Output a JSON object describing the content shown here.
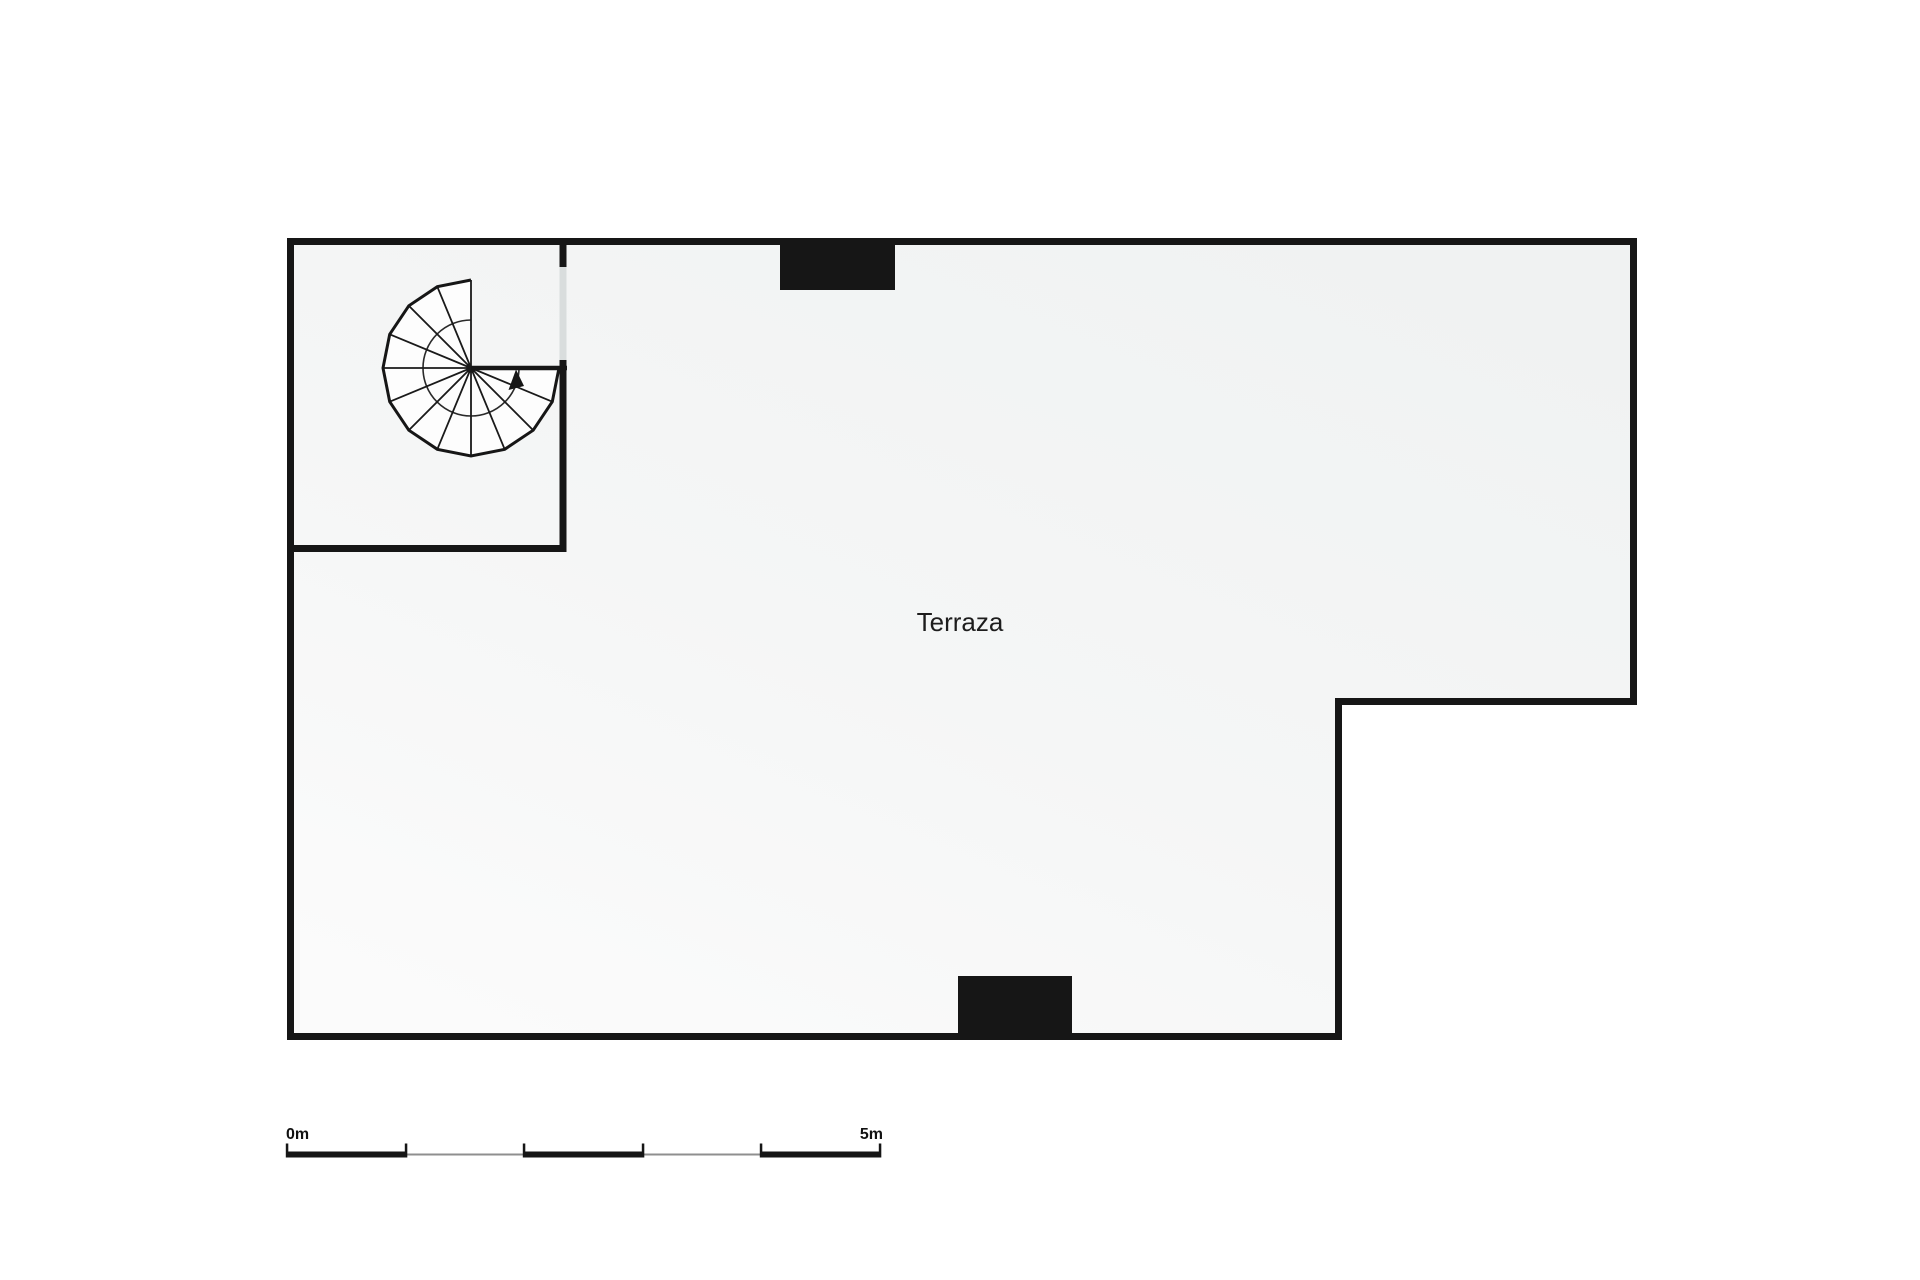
{
  "plan": {
    "room_label": "Terraza",
    "features": {
      "staircase_icon": "spiral-staircase-symbol",
      "direction_arrow_icon": "stair-direction-arrow",
      "top_block": "solid-wall-block-top",
      "bottom_block": "solid-wall-block-bottom",
      "opening": "wall-opening-stair-room"
    }
  },
  "scale_bar": {
    "start_label": "0m",
    "end_label": "5m",
    "total_meters": 5,
    "segments": 5,
    "ticks": 6
  },
  "palette": {
    "wall": "#161616",
    "floor_dark": "#f0f2f2",
    "floor_light": "#fbfbfb",
    "stair_fill": "#fdfdfd",
    "opening": "#d9dddd",
    "scale_thin_line": "#8f8f8f",
    "text": "#1d1d1d",
    "background": "#ffffff"
  }
}
